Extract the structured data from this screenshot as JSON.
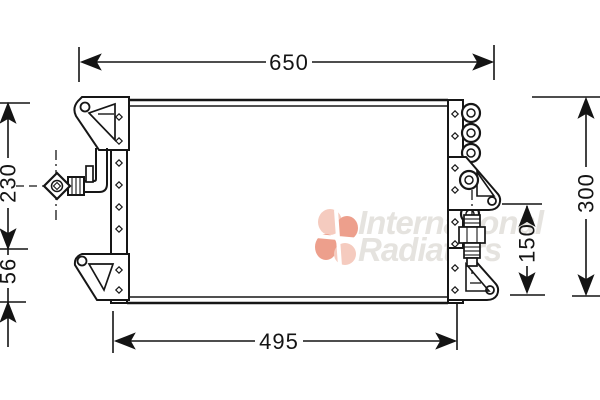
{
  "drawing": {
    "dimensions": {
      "top_width": "650",
      "left_upper": "230",
      "left_lower": "56",
      "right_full": "300",
      "right_partial": "150",
      "bottom_width": "495"
    },
    "line_color": "#161616",
    "background_color": "#ffffff"
  },
  "watermark": {
    "line1": "International",
    "line2": "Radiators",
    "text_color": "#e5e3df",
    "logo_light": "#f4c3b4",
    "logo_dark": "#ea8f78"
  }
}
